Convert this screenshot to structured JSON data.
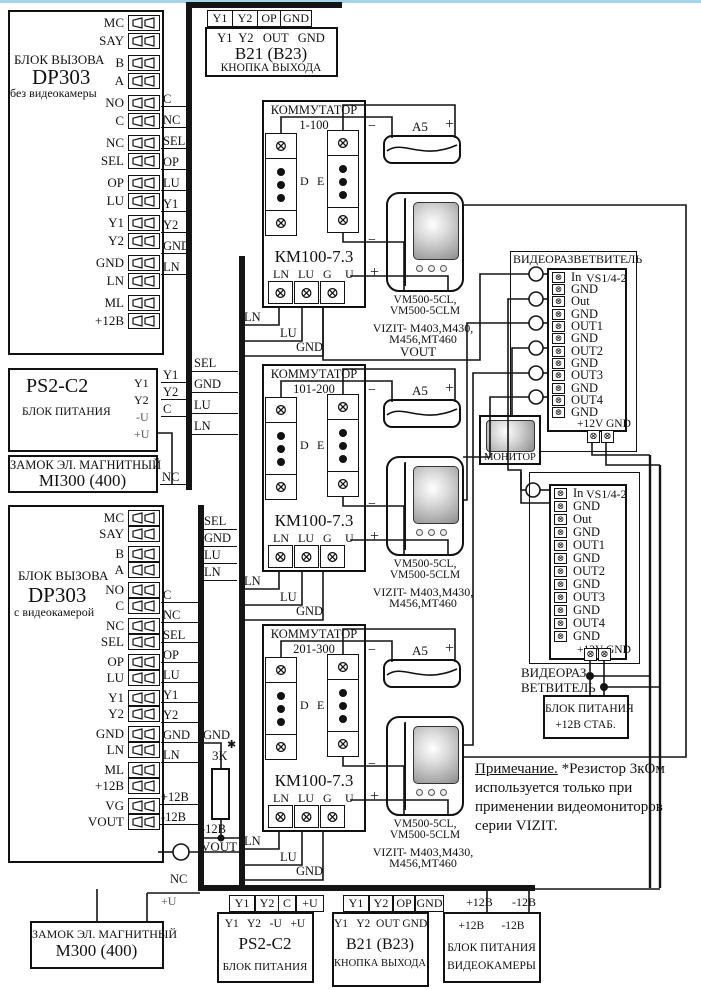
{
  "glyphs": {
    "terminal_x": "⊗",
    "asterisk": "✱"
  },
  "dp1": {
    "title": "БЛОК ВЫЗОВА",
    "model": "DP303",
    "variant": "без видеокамеры",
    "terminals": [
      "MC",
      "SAY",
      "B",
      "A",
      "NO",
      "C",
      "NC",
      "SEL",
      "OP",
      "LU",
      "Y1",
      "Y2",
      "GND",
      "LN",
      "ML",
      "+12В"
    ],
    "stubs": [
      "C",
      "NC",
      "SEL",
      "OP",
      "LU",
      "Y1",
      "Y2",
      "GND",
      "LN"
    ]
  },
  "dp2": {
    "title": "БЛОК ВЫЗОВА",
    "model": "DP303",
    "variant": "с видеокамерой",
    "terminals": [
      "MC",
      "SAY",
      "B",
      "A",
      "NO",
      "C",
      "NC",
      "SEL",
      "OP",
      "LU",
      "Y1",
      "Y2",
      "GND",
      "LN",
      "ML",
      "+12В",
      "VG",
      "VOUT"
    ],
    "stubs": [
      "C",
      "NC",
      "SEL",
      "OP",
      "LU",
      "Y1",
      "Y2",
      "GND",
      "LN"
    ],
    "power_stubs": [
      "+12В",
      "-12В"
    ]
  },
  "bus1_labels": [
    "SEL",
    "GND",
    "LU",
    "LN"
  ],
  "bus2_labels": [
    "SEL",
    "GND",
    "LU",
    "LN"
  ],
  "exit_top": {
    "bus_pins": [
      "Y1",
      "Y2",
      "OP",
      "GND"
    ],
    "pins": "Y1  Y2   OUT   GND",
    "model": "B21 (B23)",
    "name": "КНОПКА ВЫХОДА"
  },
  "exit_bottom": {
    "bus_pins": [
      "Y1",
      "Y2",
      "OP",
      "GND"
    ],
    "pins": "Y1   Y2  OUT GND",
    "model": "B21 (B23)",
    "name": "КНОПКА ВЫХОДА"
  },
  "psu1": {
    "model": "PS2-C2",
    "name": "БЛОК ПИТАНИЯ",
    "pins": [
      "Y1",
      "Y2",
      "-U",
      "+U"
    ],
    "stubs": [
      "Y1",
      "Y2",
      "C"
    ]
  },
  "psu2": {
    "bus_pins": [
      "Y1",
      "Y2",
      "C",
      "+U"
    ],
    "pins": "Y1   Y2   -U   +U",
    "model": "PS2-C2",
    "name": "БЛОК ПИТАНИЯ"
  },
  "lock1": {
    "name": "ЗАМОК ЭЛ. МАГНИТНЫЙ",
    "model": "MI300 (400)",
    "stub": "NC"
  },
  "lock2": {
    "name": "ЗАМОК ЭЛ. МАГНИТНЫЙ",
    "model": "M300 (400)"
  },
  "cam_psu": {
    "bus_pins": [
      "+12В",
      "-12В"
    ],
    "pins": "+12В      -12В",
    "name_line1": "БЛОК ПИТАНИЯ",
    "name_line2": "ВИДЕОКАМЕРЫ"
  },
  "stab_psu": {
    "line1": "БЛОК ПИТАНИЯ",
    "line2": "+12В СТАБ."
  },
  "monitor": {
    "label": "МОНИТОР"
  },
  "commutators": [
    {
      "title": "КОММУТАТОР",
      "range": "1-100",
      "model": "КМ100-7.3",
      "pins": [
        "LN",
        "LU",
        "G",
        "U"
      ],
      "col_d": "D",
      "col_e": "E",
      "minus": "−",
      "battery": "A5",
      "plus": "+",
      "hs_minus": "−",
      "hs_plus": "+",
      "hs_model1": "VM500-5CL,",
      "hs_model2": "VM500-5CLM",
      "compat1": "VIZIT- M403,M430,",
      "compat2": "M456,MT460",
      "extra": "VOUT",
      "wire_labels": [
        "LN",
        "LU",
        "GND"
      ]
    },
    {
      "title": "КОММУТАТОР",
      "range": "101-200",
      "model": "КМ100-7.3",
      "pins": [
        "LN",
        "LU",
        "G",
        "U"
      ],
      "col_d": "D",
      "col_e": "E",
      "minus": "−",
      "battery": "A5",
      "plus": "+",
      "hs_minus": "−",
      "hs_plus": "+",
      "hs_model1": "VM500-5CL,",
      "hs_model2": "VM500-5CLM",
      "compat1": "VIZIT- M403,M430,",
      "compat2": "M456,MT460",
      "extra": "",
      "wire_labels": [
        "LN",
        "LU",
        "GND"
      ]
    },
    {
      "title": "КОММУТАТОР",
      "range": "201-300",
      "model": "КМ100-7.3",
      "pins": [
        "LN",
        "LU",
        "G",
        "U"
      ],
      "col_d": "D",
      "col_e": "E",
      "minus": "−",
      "battery": "A5",
      "plus": "+",
      "hs_minus": "−",
      "hs_plus": "+",
      "hs_model1": "VM500-5CL,",
      "hs_model2": "VM500-5CLM",
      "compat1": "VIZIT- M403,M430,",
      "compat2": "M456,MT460",
      "extra": "",
      "wire_labels": [
        "LN",
        "LU",
        "GND"
      ]
    }
  ],
  "splitter1": {
    "title": "ВИДЕОРАЗВЕТВИТЕЛЬ",
    "chip": "VS1/4-2",
    "pins": [
      "In",
      "GND",
      "Out",
      "GND",
      "OUT1",
      "GND",
      "OUT2",
      "GND",
      "OUT3",
      "GND",
      "OUT4",
      "GND"
    ],
    "power": "+12V GND"
  },
  "splitter2": {
    "chip": "VS1/4-2",
    "pins": [
      "In",
      "GND",
      "Out",
      "GND",
      "OUT1",
      "GND",
      "OUT2",
      "GND",
      "OUT3",
      "GND",
      "OUT4",
      "GND"
    ],
    "power": "+12V GND",
    "label1": "ВИДЕОРАЗ-",
    "label2": "ВЕТВИТЕЛЬ"
  },
  "misc": {
    "gnd": "GND",
    "res_label": "3К",
    "res_star": "✱",
    "minus12": "-12В",
    "vout": "VOUT",
    "nc_top": "NC",
    "nc_bottom": "NC",
    "plus_u_top": "+U",
    "plus_u_bottom": "+U"
  },
  "note": {
    "label": "Примечание.",
    "text": " *Резистор 3кОм используется только при применении  видеомониторов серии VIZIT."
  }
}
